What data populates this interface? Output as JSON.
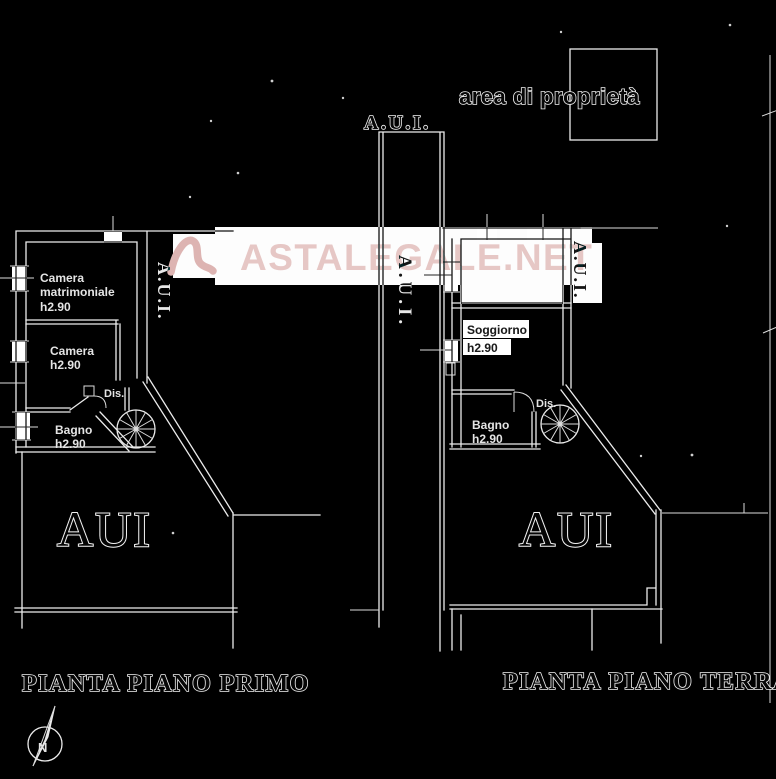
{
  "watermark": {
    "brand_text": "ASTALEGALE.NET",
    "color": "#e6c7c5"
  },
  "site": {
    "area_label": "area di proprietà",
    "aui_top": "A.U.I.",
    "aui_left_vertical": "A.U.I.",
    "aui_center_vertical": "A.U.I.",
    "aui_right_vertical": "A.U.I."
  },
  "plan_primo": {
    "caption": "PIANTA PIANO PRIMO",
    "area_text": "AUI",
    "camera_matrimoniale_line1": "Camera",
    "camera_matrimoniale_line2": "matrimoniale",
    "camera_matrimoniale_height": "h2.90",
    "camera_label": "Camera",
    "camera_height": "h2.90",
    "dis_label": "Dis.",
    "bagno_label": "Bagno",
    "bagno_height": "h2.90"
  },
  "plan_terra": {
    "caption": "PIANTA PIANO TERRA",
    "area_text": "AUI",
    "soggiorno_label": "Soggiorno",
    "soggiorno_height": "h2.90",
    "bagno_label": "Bagno",
    "bagno_height": "h2.90",
    "dis_label": "Dis."
  },
  "compass": {
    "north_label": "N"
  },
  "colors": {
    "background": "#000000",
    "line": "#ececec",
    "paper_white": "#fdfdfd",
    "watermark_pink": "#e6c7c5"
  }
}
